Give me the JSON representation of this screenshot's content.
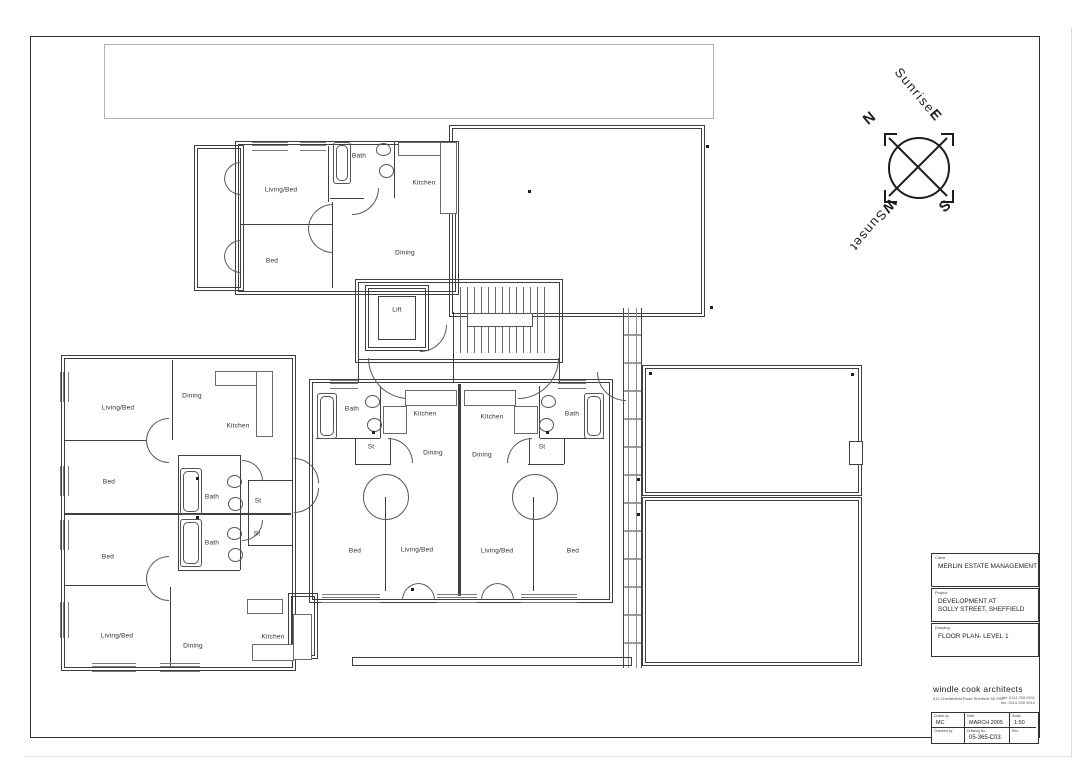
{
  "drawing": {
    "compass": {
      "n": "N",
      "e": "E",
      "s": "S",
      "w": "W",
      "sunrise": "Sunrise",
      "sunset": "Sunset"
    },
    "rooms": [
      {
        "label": "Living/Bed",
        "x": 281,
        "y": 190
      },
      {
        "label": "Bath",
        "x": 359,
        "y": 156
      },
      {
        "label": "Kitchen",
        "x": 424,
        "y": 183
      },
      {
        "label": "Bed",
        "x": 272,
        "y": 261
      },
      {
        "label": "Dining",
        "x": 405,
        "y": 253
      },
      {
        "label": "Lift",
        "x": 397,
        "y": 310
      },
      {
        "label": "Living/Bed",
        "x": 118,
        "y": 408
      },
      {
        "label": "Dining",
        "x": 192,
        "y": 396
      },
      {
        "label": "Kitchen",
        "x": 238,
        "y": 426
      },
      {
        "label": "Bed",
        "x": 109,
        "y": 482
      },
      {
        "label": "Bath",
        "x": 212,
        "y": 497
      },
      {
        "label": "St",
        "x": 258,
        "y": 501
      },
      {
        "label": "Bed",
        "x": 108,
        "y": 557
      },
      {
        "label": "Bath",
        "x": 212,
        "y": 543
      },
      {
        "label": "St",
        "x": 257,
        "y": 534
      },
      {
        "label": "Living/Bed",
        "x": 117,
        "y": 636
      },
      {
        "label": "Dining",
        "x": 193,
        "y": 646
      },
      {
        "label": "Kitchen",
        "x": 273,
        "y": 637
      },
      {
        "label": "Bath",
        "x": 352,
        "y": 409
      },
      {
        "label": "St",
        "x": 371,
        "y": 447
      },
      {
        "label": "Kitchen",
        "x": 425,
        "y": 414
      },
      {
        "label": "Dining",
        "x": 433,
        "y": 453
      },
      {
        "label": "Kitchen",
        "x": 492,
        "y": 417
      },
      {
        "label": "Dining",
        "x": 482,
        "y": 455
      },
      {
        "label": "St",
        "x": 542,
        "y": 447
      },
      {
        "label": "Bath",
        "x": 572,
        "y": 414
      },
      {
        "label": "Bed",
        "x": 355,
        "y": 551
      },
      {
        "label": "Living/Bed",
        "x": 417,
        "y": 550
      },
      {
        "label": "Living/Bed",
        "x": 497,
        "y": 551
      },
      {
        "label": "Bed",
        "x": 573,
        "y": 551
      }
    ],
    "title_block": {
      "client_label": "Client",
      "client": "MERLIN ESTATE MANAGEMENT",
      "project_label": "Project",
      "project_line1": "DEVELOPMENT AT",
      "project_line2": "SOLLY STREET, SHEFFIELD",
      "drawing_label": "Drawing",
      "drawing_title": "FLOOR PLAN- LEVEL 1",
      "firm_name": "windle cook architects",
      "firm_address": "511 Chesterfield Road  Sheffield S8 0RE",
      "firm_tel": "tel. 0114 255 9911",
      "firm_fax": "fax. 0114 255 9910",
      "drawn_by_label": "Drawn by",
      "drawn_by": "MC",
      "date_label": "Date",
      "date": "MARCH 2005",
      "scale_label": "Scale",
      "scale": "1:50",
      "checked_by_label": "Checked by",
      "checked_by": "",
      "drawing_no_label": "Drawing No.",
      "drawing_no": "05-365-C03",
      "rev_label": "Rev.",
      "rev": ""
    }
  }
}
